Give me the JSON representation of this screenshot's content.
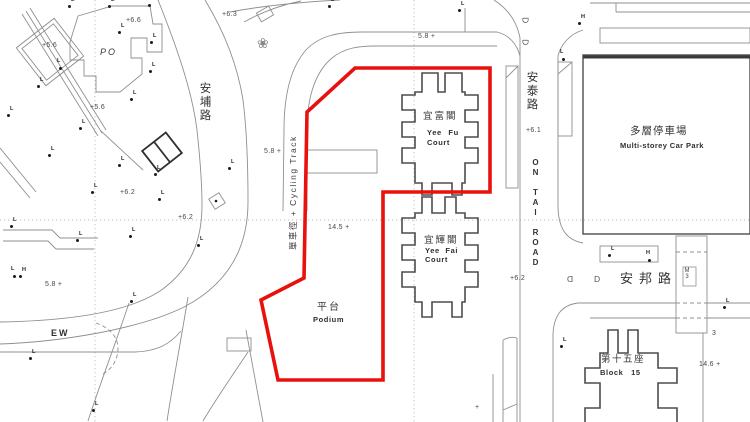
{
  "colors": {
    "boundary_red": "#e8110e",
    "line_gray": "#8f8f8f",
    "building_gray": "#4d4d4d"
  },
  "roads": {
    "on_po_cn": "安埔路",
    "on_tai_cn": "安泰路",
    "on_tai_en": "ON TAI ROAD",
    "on_pong_cn": "安邦路",
    "cycling_track": "單車徑 + Cycling Track"
  },
  "buildings": {
    "yee_fu_cn": "宜富閣",
    "yee_fu_en1": "Yee Fu",
    "yee_fu_en2": "Court",
    "yee_fai_cn": "宜輝閣",
    "yee_fai_en1": "Yee Fai",
    "yee_fai_en2": "Court",
    "block15_cn": "第十五座",
    "block15_en": "Block 15",
    "carpark_cn": "多層停車場",
    "carpark_en": "Multi-storey Car Park",
    "podium_cn": "平台",
    "podium_en": "Podium",
    "po": "PO",
    "ew": "EW",
    "m3": "M3"
  },
  "spot_heights": [
    {
      "t": "+5.6"
    },
    {
      "t": "+5.6"
    },
    {
      "t": "+6.6"
    },
    {
      "t": "+6.3"
    },
    {
      "t": "+6.2"
    },
    {
      "t": "+6.2"
    },
    {
      "t": "5.8 +"
    },
    {
      "t": "5.8 +"
    },
    {
      "t": "5.8 +"
    },
    {
      "t": "+6.1"
    },
    {
      "t": "+6.2"
    },
    {
      "t": "14.5 +"
    },
    {
      "t": "14.6 +"
    },
    {
      "t": "3"
    },
    {
      "t": "+"
    }
  ],
  "markers": {
    "lamp": "L",
    "hydrant": "H"
  },
  "symbols": {
    "d": "D",
    "tree": "❀"
  }
}
